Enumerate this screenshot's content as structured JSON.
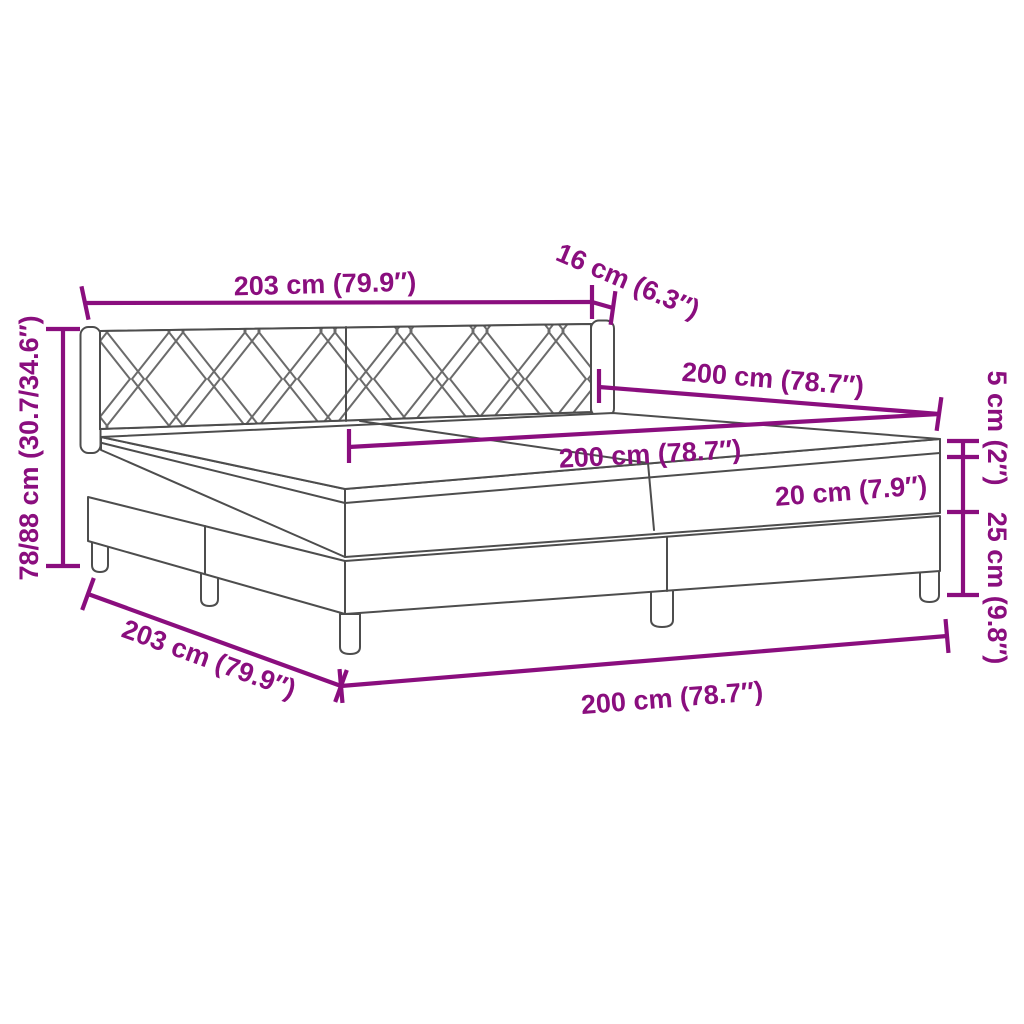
{
  "diagram": {
    "type": "product-dimension-diagram",
    "subject": "box spring bed with headboard, two-part mattress and legs",
    "colors": {
      "dimension_annotation": "#8A0E7E",
      "drawing_outline": "#4d4d4d",
      "background": "#ffffff"
    }
  },
  "measurements": {
    "headboard_width": {
      "cm": "203",
      "inches": "79.9",
      "label": "203 cm (79.9″)"
    },
    "headboard_depth": {
      "cm": "16",
      "inches": "6.3",
      "label": "16 cm (6.3″)"
    },
    "overall_height": {
      "cm": "78/88",
      "inches": "30.7/34.6",
      "label": "78/88 cm (30.7/34.6″)"
    },
    "bed_length_top": {
      "cm": "200",
      "inches": "78.7",
      "label": "200 cm (78.7″)"
    },
    "mattress_width": {
      "cm": "200",
      "inches": "78.7",
      "label": "200 cm (78.7″)"
    },
    "topper_height": {
      "cm": "5",
      "inches": "2",
      "label": "5 cm (2″)"
    },
    "mattress_height": {
      "cm": "20",
      "inches": "7.9",
      "label": "20 cm (7.9″)"
    },
    "box_height": {
      "cm": "25",
      "inches": "9.8",
      "label": "25 cm (9.8″)"
    },
    "base_depth": {
      "cm": "203",
      "inches": "79.9",
      "label": "203 cm (79.9″)"
    },
    "base_width": {
      "cm": "200",
      "inches": "78.7",
      "label": "200 cm (78.7″)"
    }
  }
}
